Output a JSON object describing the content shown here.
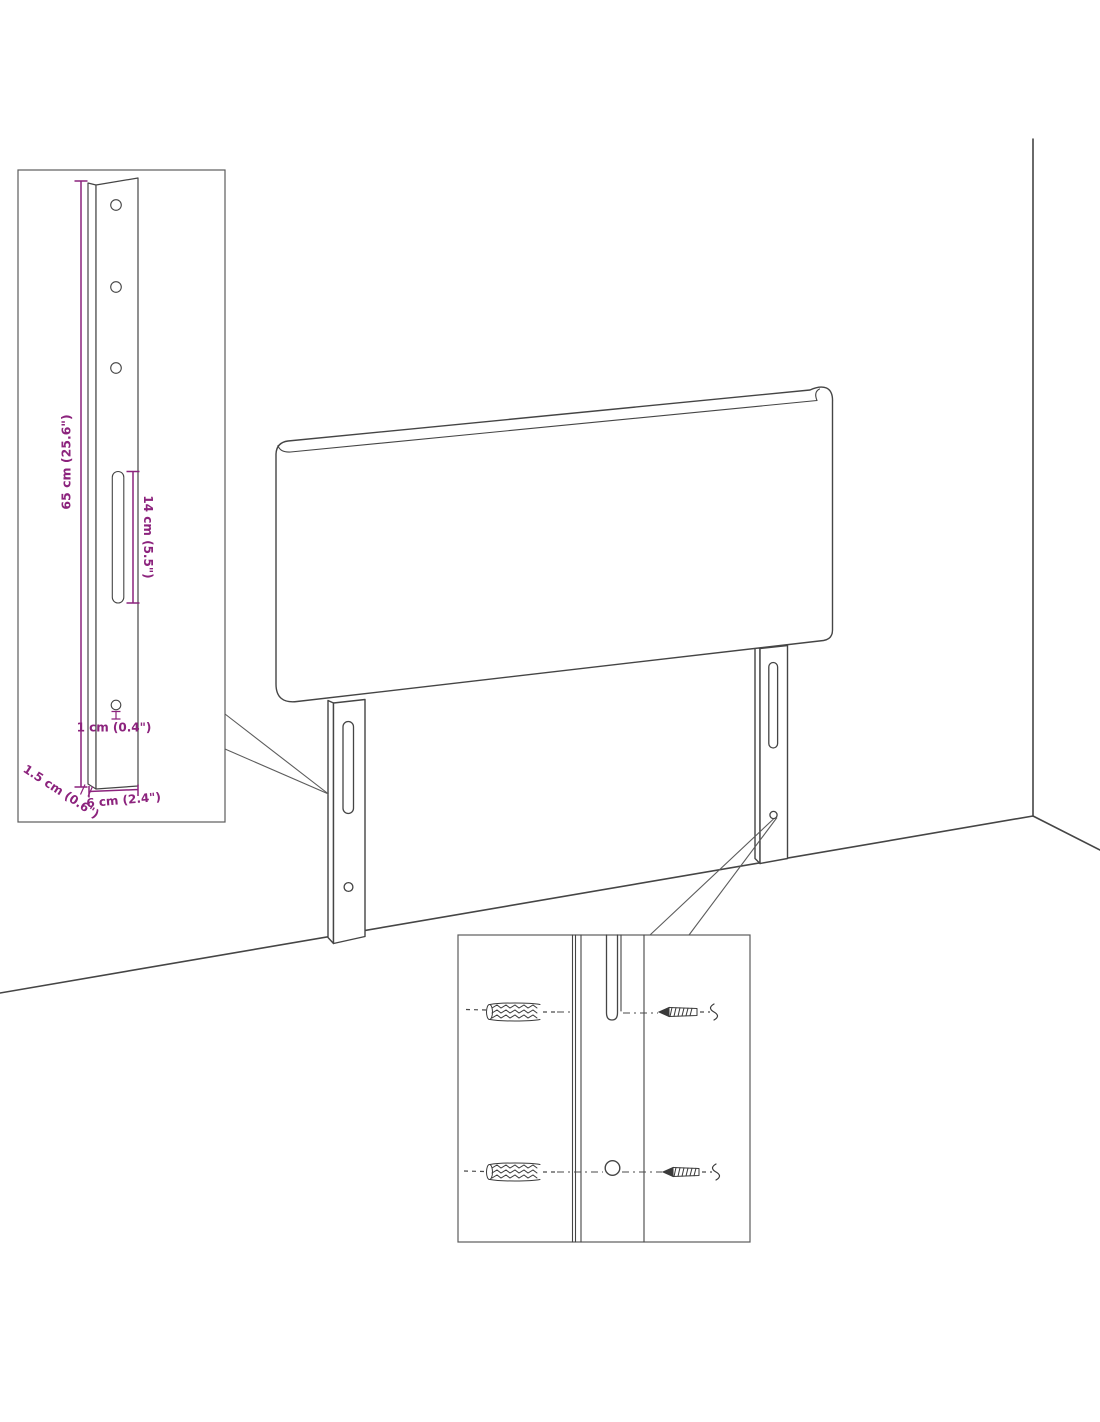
{
  "figure": {
    "type": "furniture-assembly-diagram",
    "subject": "Upholstered headboard with two slotted wall-mount legs shown against a room corner, with two detail callouts",
    "colors": {
      "dimension": "#8c237d",
      "outline": "#454545",
      "line_soft": "#5c5c5c",
      "background": "#ffffff"
    },
    "callout_bracket": {
      "description": "Front view of mounting leg with three drill holes, keyhole slot and one lower hole",
      "dims": {
        "height": "65 cm (25.6\")",
        "slot": "14 cm (5.5\")",
        "hole": "1 cm (0.4\")",
        "width": "6 cm (2.4\")",
        "depth": "1.5 cm (0.6\")"
      }
    },
    "callout_mounting": {
      "description": "Close-up of leg slot and lower hole aligned with wall plugs and screws"
    }
  }
}
